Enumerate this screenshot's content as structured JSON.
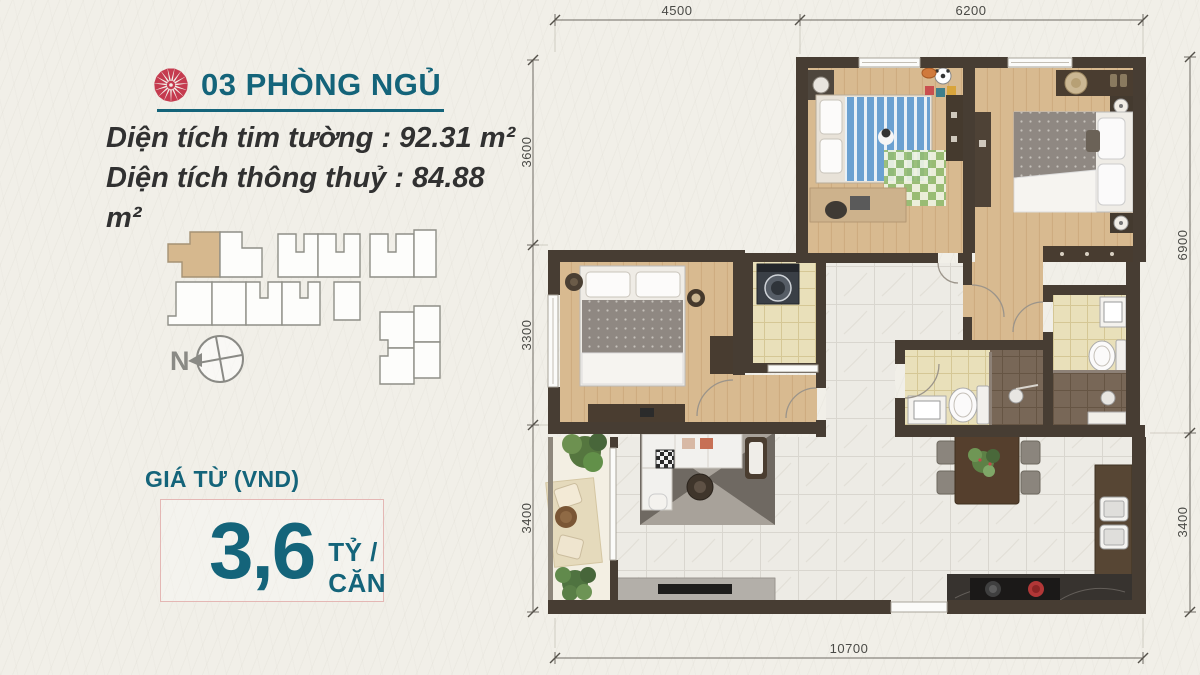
{
  "listing": {
    "title": "03 PHÒNG NGỦ",
    "area_line_1": "Diện tích tim tường : 92.31 m²",
    "area_line_2": "Diện tích thông thuỷ : 84.88 m²",
    "price_label": "GIÁ TỪ (VND)",
    "price_amount": "3,6",
    "price_unit": "TỶ / CĂN"
  },
  "key_plan": {
    "north_label": "N",
    "highlight_color": "#d6b88e"
  },
  "floor_plan": {
    "dim_top_left": "4500",
    "dim_top_right": "6200",
    "dim_left_1": "3600",
    "dim_left_2": "3300",
    "dim_left_3": "3400",
    "dim_right_1": "6900",
    "dim_right_2": "3400",
    "dim_bottom": "10700"
  },
  "colors": {
    "accent_teal": "#14647a",
    "flower_red": "#c53b4f",
    "price_box_border": "#e4b7b4",
    "wall": "#473d33",
    "wood_floor": "#d8ba90",
    "marble_floor": "#edebe5"
  }
}
